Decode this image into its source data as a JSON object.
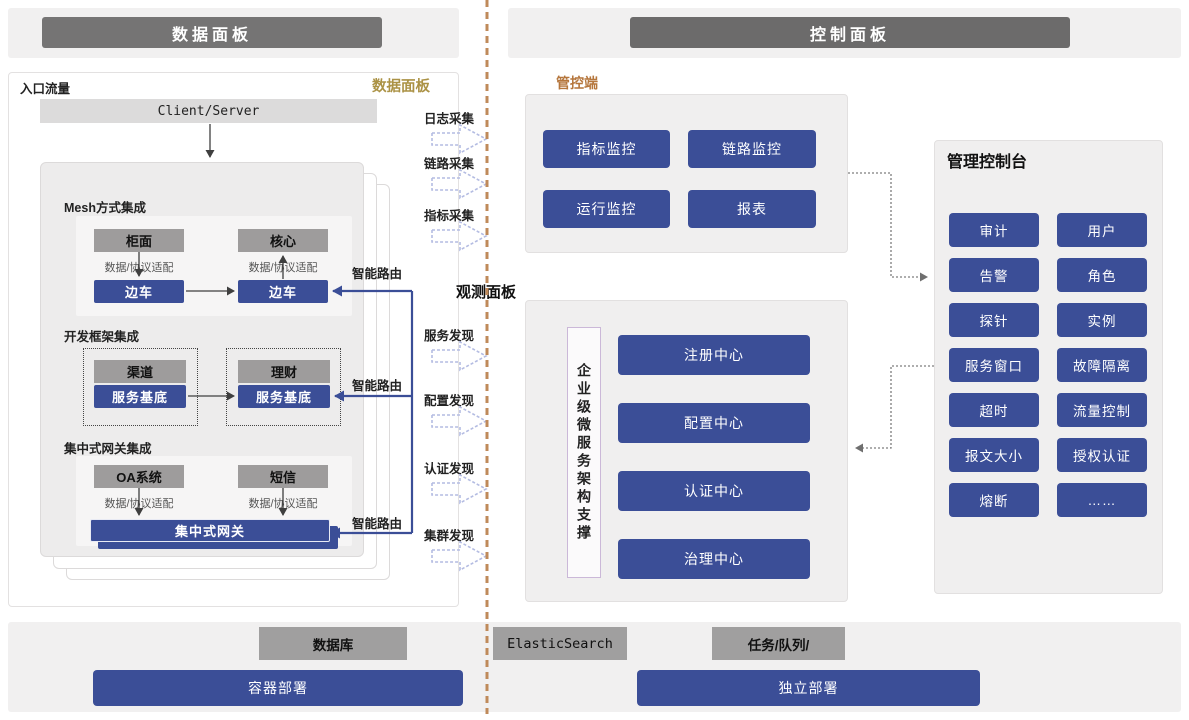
{
  "headers": {
    "left": "数据面板",
    "right": "控制面板"
  },
  "data_plane": {
    "corner_label": "入口流量",
    "panel_tag": "数据面板",
    "client_server": "Client/Server",
    "sections": {
      "mesh": {
        "title": "Mesh方式集成",
        "left_app": "柜面",
        "right_app": "核心",
        "left_adapter": "数据/协议适配",
        "right_adapter": "数据/协议适配",
        "left_sidecar": "边车",
        "right_sidecar": "边车"
      },
      "framework": {
        "title": "开发框架集成",
        "left_app": "渠道",
        "right_app": "理财",
        "left_base": "服务基底",
        "right_base": "服务基底"
      },
      "gateway": {
        "title": "集中式网关集成",
        "left_app": "OA系统",
        "right_app": "短信",
        "left_adapter": "数据/协议适配",
        "right_adapter": "数据/协议适配",
        "gateway_label": "集中式网关"
      }
    },
    "smart_route_labels": [
      "智能路由",
      "智能路由",
      "智能路由"
    ]
  },
  "flow_labels": {
    "collect": [
      "日志采集",
      "链路采集",
      "指标采集"
    ],
    "observe_panel": "观测面板",
    "discover": [
      "服务发现",
      "配置发现",
      "认证发现",
      "集群发现"
    ]
  },
  "control_plane": {
    "console_tag": "管控端",
    "monitor_buttons": [
      "指标监控",
      "链路监控",
      "运行监控",
      "报表"
    ],
    "support_vertical": "企业级微服务架构支撑",
    "centers": [
      "注册中心",
      "配置中心",
      "认证中心",
      "治理中心"
    ],
    "admin_console": {
      "title": "管理控制台",
      "buttons": [
        "审计",
        "用户",
        "告警",
        "角色",
        "探针",
        "实例",
        "服务窗口",
        "故障隔离",
        "超时",
        "流量控制",
        "报文大小",
        "授权认证",
        "熔断",
        "……"
      ]
    }
  },
  "infrastructure": {
    "database": "数据库",
    "elasticsearch": "ElasticSearch",
    "task_queue": "任务/队列/",
    "container_deploy": "容器部署",
    "standalone_deploy": "独立部署"
  },
  "colors": {
    "accent_blue": "#3b4e97",
    "gray_node": "#9e9c9c",
    "header_gray": "#757474",
    "gold": "#ab9245",
    "orange": "#b5763c",
    "dashed_divider": "#bf8a5a"
  }
}
